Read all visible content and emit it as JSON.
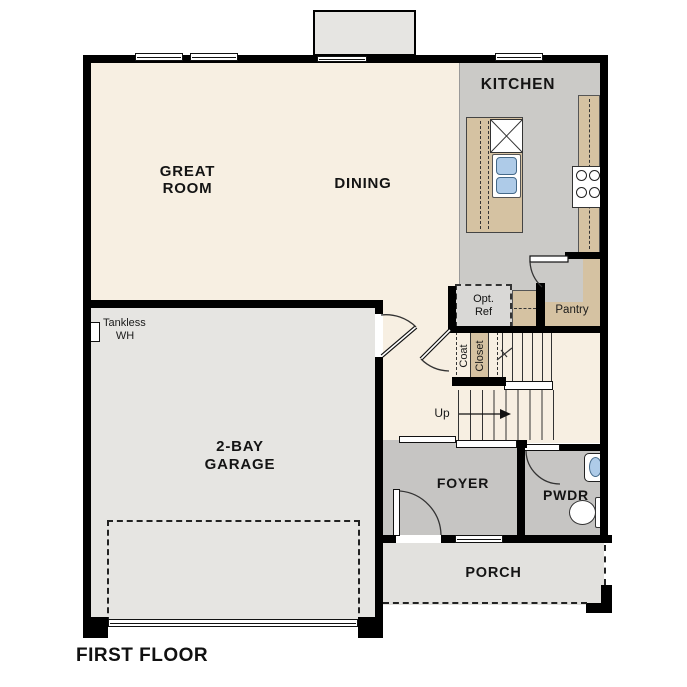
{
  "plan_title": "FIRST FLOOR",
  "rooms": {
    "great_room": {
      "line1": "GREAT",
      "line2": "ROOM"
    },
    "dining": {
      "label": "DINING"
    },
    "kitchen": {
      "label": "KITCHEN"
    },
    "garage": {
      "line1": "2-BAY",
      "line2": "GARAGE"
    },
    "foyer": {
      "label": "FOYER"
    },
    "powder": {
      "label": "PWDR"
    },
    "porch": {
      "label": "PORCH"
    },
    "pantry": {
      "label": "Pantry"
    }
  },
  "features": {
    "dishwasher": {
      "label": "DW"
    },
    "optional_refrigerator": {
      "line1": "Opt.",
      "line2": "Ref"
    },
    "tankless_water_heater": {
      "line1": "Tankless",
      "line2": "WH"
    },
    "coat_closet": {
      "line1": "Coat",
      "line2": "Closet"
    },
    "stairs": {
      "direction_label": "Up"
    }
  },
  "colors": {
    "wall": "#000000",
    "living_floor": "#f7efe2",
    "kitchen_floor": "#cbcac7",
    "counter_tan": "#d5c2a2",
    "garage_floor": "#e6e5e2",
    "foyer_floor": "#c6c5c3",
    "porch_floor": "#e2e1de",
    "fixture_blue": "#aecbe8"
  }
}
